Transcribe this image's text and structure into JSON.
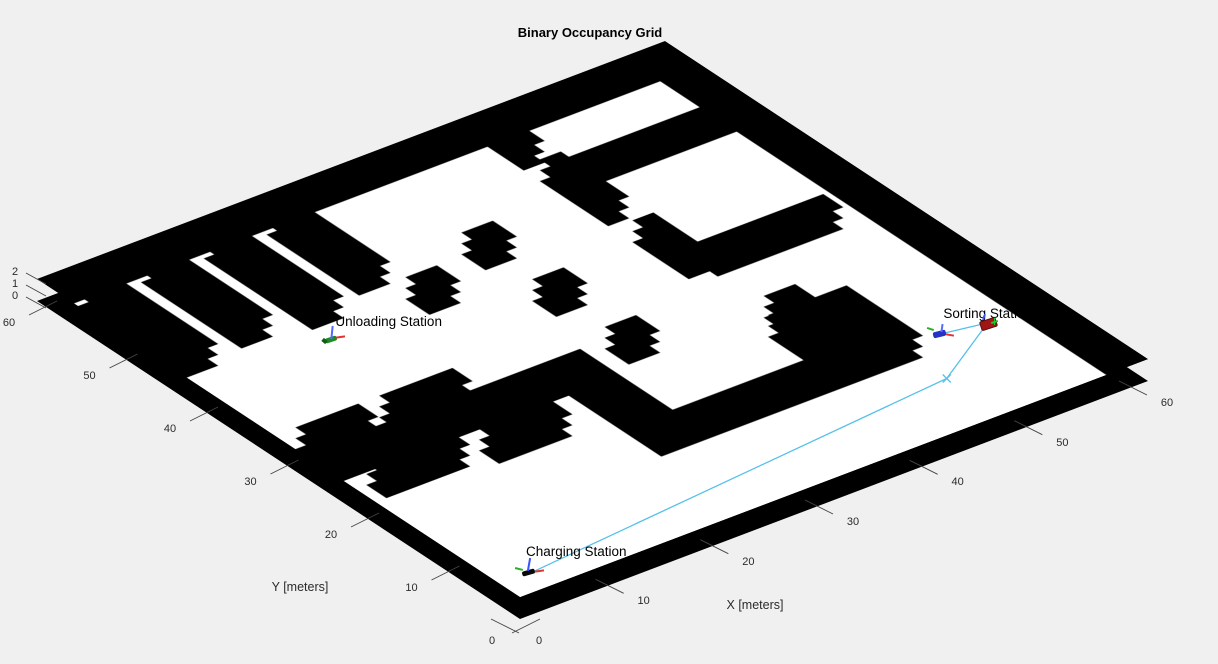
{
  "title": "Binary Occupancy Grid",
  "axes": {
    "x_label": "X [meters]",
    "y_label": "Y [meters]",
    "x_ticks": [
      0,
      10,
      20,
      30,
      40,
      50,
      60
    ],
    "y_ticks": [
      60,
      50,
      40,
      30,
      20,
      10,
      0
    ],
    "z_ticks": [
      2,
      1,
      0
    ]
  },
  "stations": [
    {
      "label": "Unloading Station",
      "x": 12.3,
      "y": 39.3,
      "marker": "axes-green"
    },
    {
      "label": "Sorting Station",
      "x": 49.8,
      "y": 12.4,
      "marker": "axes-blue"
    },
    {
      "label": "Charging Station",
      "x": 2.8,
      "y": 2.4,
      "marker": "robot-black"
    }
  ],
  "robot": {
    "x": 53.6,
    "y": 11.6,
    "marker": "vehicle-red"
  },
  "chart_data": {
    "type": "occupancy_grid_3d",
    "title": "Binary Occupancy Grid",
    "xlabel": "X [meters]",
    "ylabel": "Y [meters]",
    "xlim": [
      0,
      60
    ],
    "ylim": [
      0,
      60
    ],
    "zlim": [
      0,
      2
    ],
    "floor_color": "#ffffff",
    "occupied_color": "#000000",
    "background_color": "#f0f0f0",
    "path_color": "#55c0ea",
    "obstacles": [
      {
        "name": "top-wall",
        "rect": [
          0,
          58,
          60,
          60
        ]
      },
      {
        "name": "right-wall",
        "rect": [
          58,
          0,
          60,
          60
        ]
      },
      {
        "name": "rack-1",
        "rect": [
          2,
          44,
          5,
          57.5
        ]
      },
      {
        "name": "rack-2",
        "rect": [
          8,
          45,
          11,
          57.5
        ]
      },
      {
        "name": "rack-3",
        "rect": [
          14,
          44,
          17,
          57.5
        ]
      },
      {
        "name": "rack-4",
        "rect": [
          20,
          46,
          23,
          57.5
        ]
      },
      {
        "name": "pillar-1",
        "rect": [
          30,
          43.3,
          33,
          46.3
        ]
      },
      {
        "name": "pillar-2",
        "rect": [
          30,
          34.5,
          33,
          37.5
        ]
      },
      {
        "name": "pillar-3",
        "rect": [
          30,
          25.5,
          33,
          28.5
        ]
      },
      {
        "name": "pillar-4",
        "rect": [
          22.5,
          40.5,
          25.5,
          43.5
        ]
      },
      {
        "name": "room-wall-left-upper",
        "rect": [
          41.5,
          53.5,
          43.5,
          58
        ]
      },
      {
        "name": "room-wall-left-mid",
        "rect": [
          41.5,
          43,
          43.5,
          51.5
        ]
      },
      {
        "name": "room-divider",
        "rect": [
          43.5,
          48.5,
          58,
          50.5
        ]
      },
      {
        "name": "room-wall-left-lower",
        "rect": [
          41.5,
          33,
          43.5,
          40
        ]
      },
      {
        "name": "room-wall-bottom",
        "rect": [
          43.5,
          32,
          55.5,
          34.5
        ]
      },
      {
        "name": "mid-wall",
        "rect": [
          0,
          24.5,
          26.5,
          27
        ]
      },
      {
        "name": "mid-wall-connector",
        "rect": [
          23.5,
          13,
          26.5,
          24.5
        ]
      },
      {
        "name": "south-bar",
        "rect": [
          24,
          13,
          48.5,
          15.5
        ]
      },
      {
        "name": "south-block",
        "rect": [
          41,
          15,
          48.5,
          22.5
        ]
      },
      {
        "name": "south-block-nub",
        "rect": [
          42.5,
          22.5,
          45.5,
          25
        ]
      },
      {
        "name": "shelf-upper-1",
        "rect": [
          2,
          28,
          8,
          30.5
        ]
      },
      {
        "name": "shelf-upper-2",
        "rect": [
          10,
          28,
          17,
          30.5
        ]
      },
      {
        "name": "shelf-lower-1",
        "rect": [
          3,
          20.5,
          11,
          23
        ]
      },
      {
        "name": "shelf-lower-2",
        "rect": [
          13,
          19.5,
          20,
          22
        ]
      }
    ],
    "path": {
      "waypoints": [
        [
          2.8,
          2.4
        ],
        [
          46,
          6.8
        ],
        [
          53.6,
          11.6
        ]
      ],
      "branch": [
        [
          49.8,
          12.4
        ],
        [
          53.6,
          11.6
        ]
      ],
      "kink_marker": [
        46,
        6.8
      ]
    }
  }
}
